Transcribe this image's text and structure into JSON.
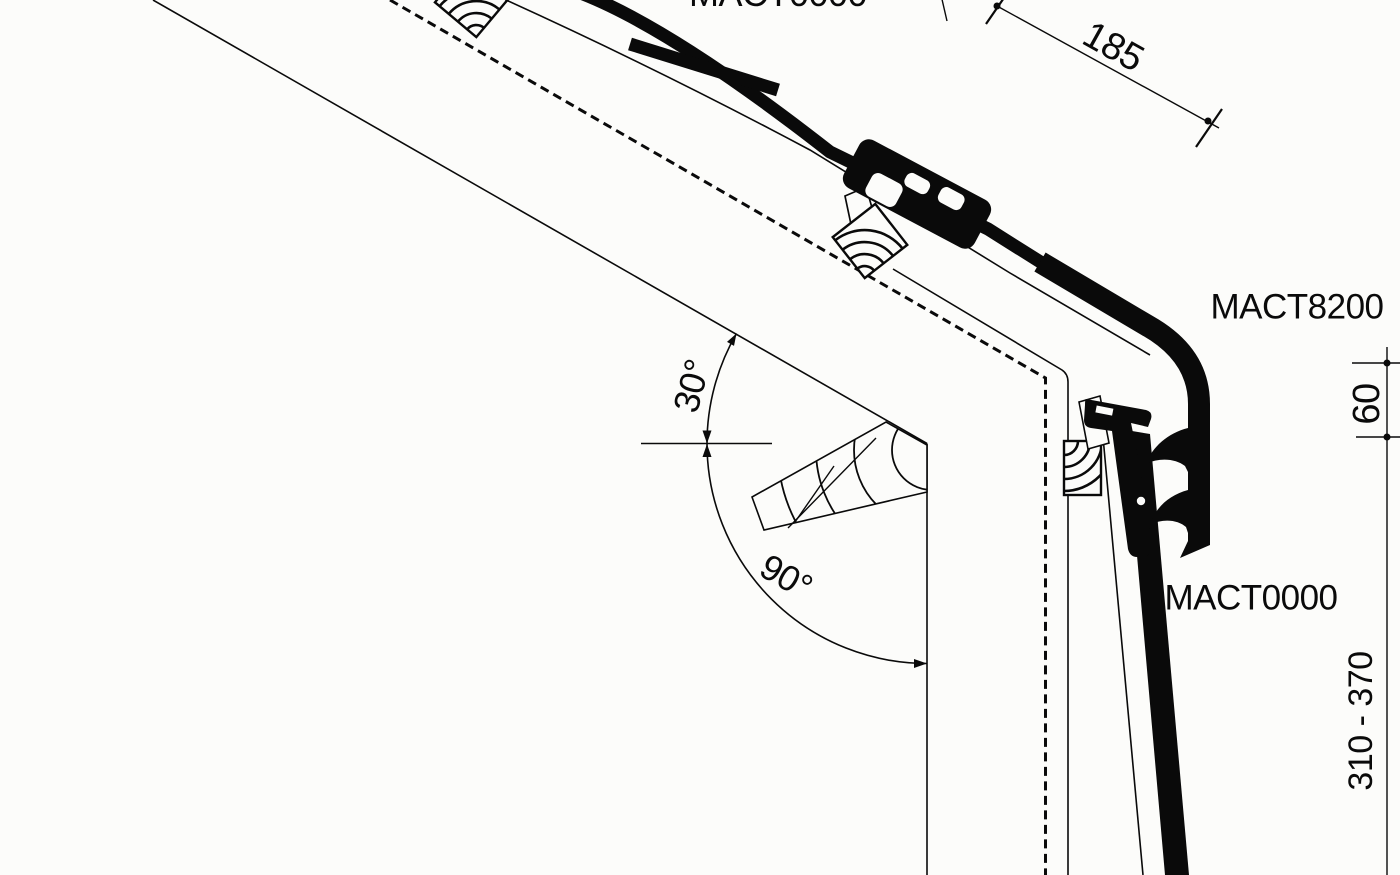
{
  "drawing": {
    "type": "roof-edge cross-section detail",
    "labels": {
      "top_profile": "MACT0000",
      "corner_profile": "MACT8200",
      "wall_profile": "MACT0000"
    },
    "dimensions": {
      "slope_length": "185",
      "corner_drop": "60",
      "wall_range": "310 - 370",
      "roof_pitch_angle": "30°",
      "wall_angle": "90°"
    },
    "colors": {
      "ink": "#0a0a0a",
      "background": "#fcfcfa"
    }
  }
}
